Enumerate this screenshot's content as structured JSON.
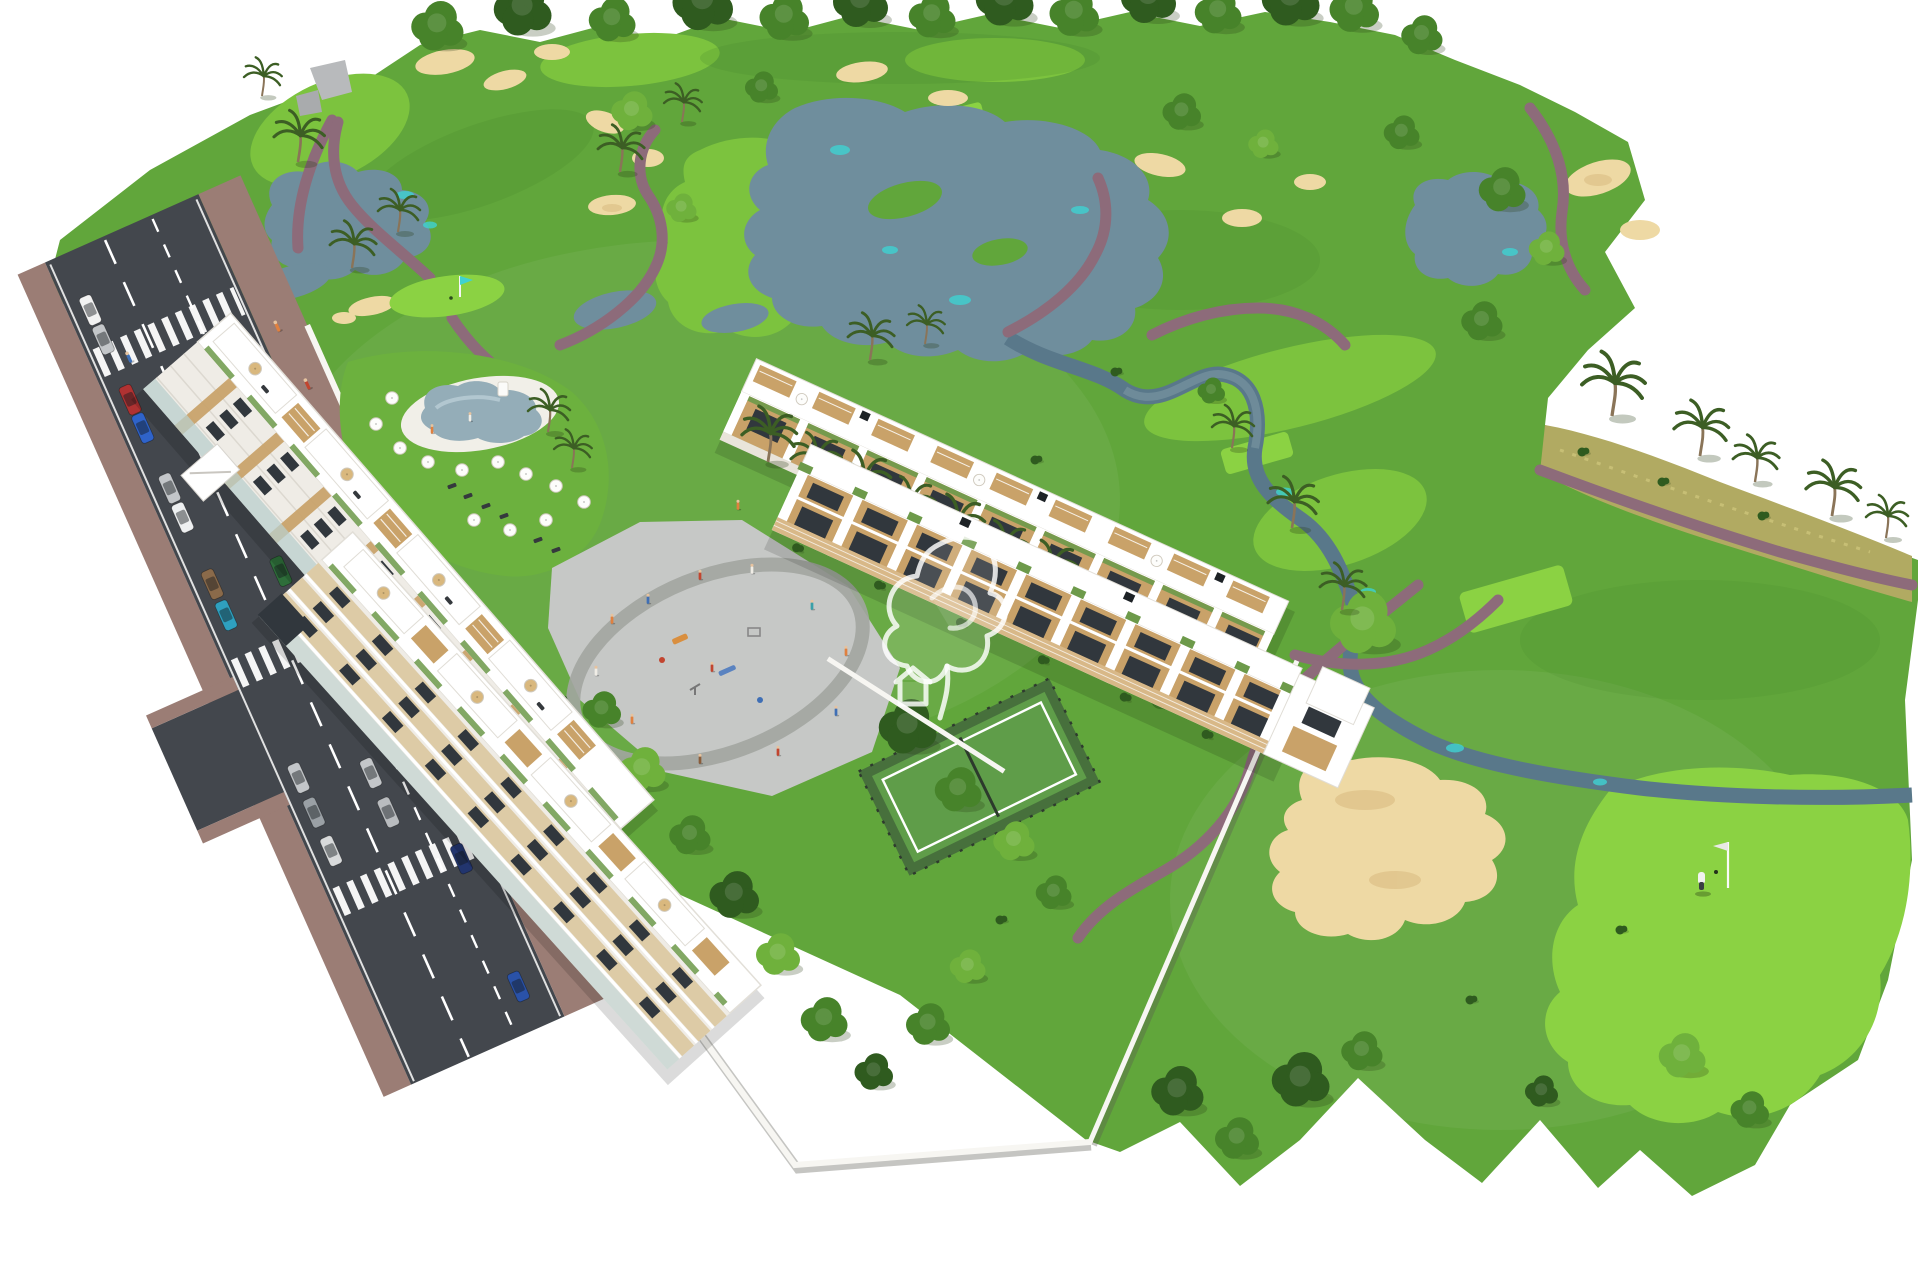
{
  "scene": {
    "description": "Aerial 3D architectural rendering of a golf-resort residential development: two white apartment blocks and two townhouse rows around a playground plaza, swimming pool with umbrellas, paddle tennis court, tree-lined access road with parked cars and crosswalks, surrounded by a golf course with lakes, sand bunkers, winding paths, palm trees, a golfer on a green and a semi-transparent white watermark logo over the houses.",
    "watermark_present": true
  },
  "palette": {
    "bg": "#ffffff",
    "grass": "#61a63b",
    "grass_dark": "#4a8a2d",
    "fairway": "#7cc33e",
    "bright_green": "#8bd243",
    "scrub": "#b1aa62",
    "sand": "#eed9a4",
    "sand_shadow": "#d9ba7f",
    "water": "#6f8e9d",
    "water_dark": "#59788a",
    "teal": "#3fd2d2",
    "path": "#8d6b7a",
    "road": "#43474d",
    "road_ramp": "#4d5157",
    "sidewalk": "#9b7d75",
    "pavement": "#c9cccd",
    "building": "#ffffff",
    "building_shade": "#e8e5df",
    "facade": "#efece6",
    "beige": "#ddcba6",
    "wood": "#c9a269",
    "wood_dark": "#a87f4c",
    "glass": "#31373d",
    "balcony_glass": "#b9cfcc",
    "green_roof": "#6d9a4a",
    "tree": "#47832a",
    "tree_dark": "#2f5b1f",
    "tree_light": "#6fb13c",
    "palm": "#3c5e24",
    "pool": "#94adb8",
    "court": "#5f9d49",
    "court_dark": "#47703c",
    "plaza": "#c6c8c6",
    "plaza_ring": "#a2a5a0",
    "white_wall": "#f7f6f2",
    "watermark": "rgba(255,255,255,0.82)"
  },
  "road": {
    "lanes": 2,
    "parking_lane": true,
    "crosswalk_count": 3,
    "side_junction": true,
    "parked_car_colors": [
      "#f2f2f2",
      "#c3c6c9",
      "#b03232",
      "#2f63c9",
      "#c3c6c9",
      "#eef0f1",
      "#8a6a4a",
      "#2fa0bf",
      "#c3c6c9",
      "#9aa0a5",
      "#d8dadb"
    ],
    "moving_car_colors": [
      "#2e6e3a",
      "#3c8a4a",
      "#c3c6c9",
      "#b9bcbf",
      "#22356e",
      "#2a52a8"
    ]
  },
  "golf": {
    "lake_count": 3,
    "pond_count": 3,
    "bunker_count": 16,
    "flag_count": 2,
    "golfer_count": 1,
    "cart_count": 1,
    "stream": true
  },
  "residential": {
    "apartment_blocks": 2,
    "townhouse_rows": 2,
    "pool_count": 1,
    "pool_umbrella_count": 12,
    "paddle_court_count": 1,
    "playground_count": 1
  },
  "people_colors": [
    "#e0803f",
    "#c2452f",
    "#3f6fb5",
    "#f0ede6",
    "#3aa0a8",
    "#8a5d3b"
  ]
}
